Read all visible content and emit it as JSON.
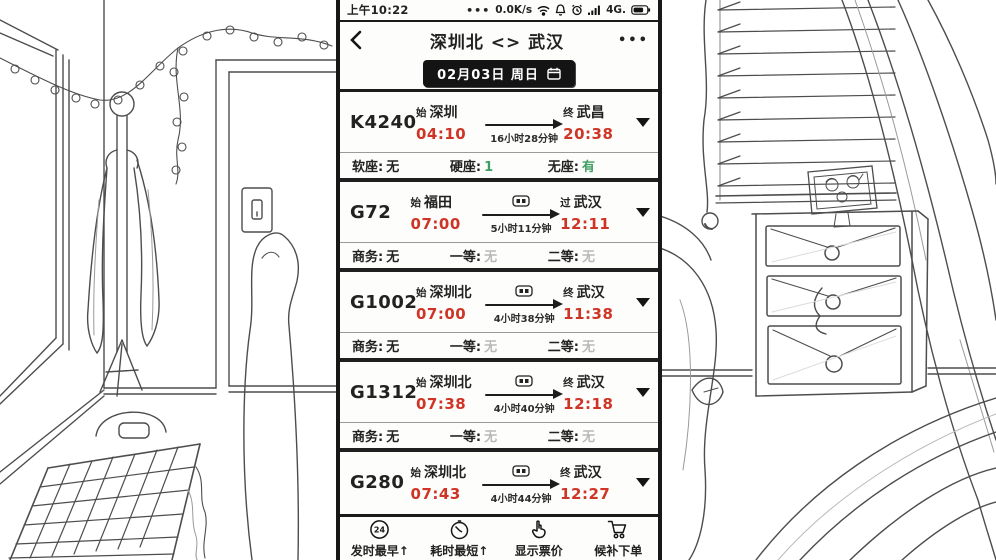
{
  "status_bar": {
    "time": "上午10:22",
    "more": "•••",
    "net_speed": "0.0K/s",
    "network": "4G."
  },
  "header": {
    "title": "深圳北 <> 武汉",
    "more": "•••"
  },
  "date_bar": {
    "text": "02月03日 周日"
  },
  "trains": [
    {
      "code": "K4240",
      "from_prefix": "始",
      "from": "深圳",
      "depart": "04:10",
      "duration": "16小时28分钟",
      "to_prefix": "终",
      "to": "武昌",
      "arrive": "20:38",
      "seats": [
        {
          "label": "软座:",
          "value": "无"
        },
        {
          "label": "硬座:",
          "value": "1"
        },
        {
          "label": "无座:",
          "value": "有"
        }
      ]
    },
    {
      "code": "G72",
      "from_prefix": "始",
      "from": "福田",
      "depart": "07:00",
      "duration": "5小时11分钟",
      "to_prefix": "过",
      "to": "武汉",
      "arrive": "12:11",
      "seats": [
        {
          "label": "商务:",
          "value": "无"
        },
        {
          "label": "一等:",
          "value": "无"
        },
        {
          "label": "二等:",
          "value": "无"
        }
      ]
    },
    {
      "code": "G1002",
      "from_prefix": "始",
      "from": "深圳北",
      "depart": "07:00",
      "duration": "4小时38分钟",
      "to_prefix": "终",
      "to": "武汉",
      "arrive": "11:38",
      "seats": [
        {
          "label": "商务:",
          "value": "无"
        },
        {
          "label": "一等:",
          "value": "无"
        },
        {
          "label": "二等:",
          "value": "无"
        }
      ]
    },
    {
      "code": "G1312",
      "from_prefix": "始",
      "from": "深圳北",
      "depart": "07:38",
      "duration": "4小时40分钟",
      "to_prefix": "终",
      "to": "武汉",
      "arrive": "12:18",
      "seats": [
        {
          "label": "商务:",
          "value": "无"
        },
        {
          "label": "一等:",
          "value": "无"
        },
        {
          "label": "二等:",
          "value": "无"
        }
      ]
    },
    {
      "code": "G280",
      "from_prefix": "始",
      "from": "深圳北",
      "depart": "07:43",
      "duration": "4小时44分钟",
      "to_prefix": "终",
      "to": "武汉",
      "arrive": "12:27",
      "seats": []
    }
  ],
  "bottom_bar": {
    "items": [
      {
        "label": "发时最早↑"
      },
      {
        "label": "耗时最短↑"
      },
      {
        "label": "显示票价"
      },
      {
        "label": "候补下单"
      }
    ]
  },
  "colors": {
    "time_red": "#cf3526",
    "available_green": "#3f9e63",
    "soldout_gray": "#b9b9b9",
    "ink": "#1a1a1a"
  }
}
